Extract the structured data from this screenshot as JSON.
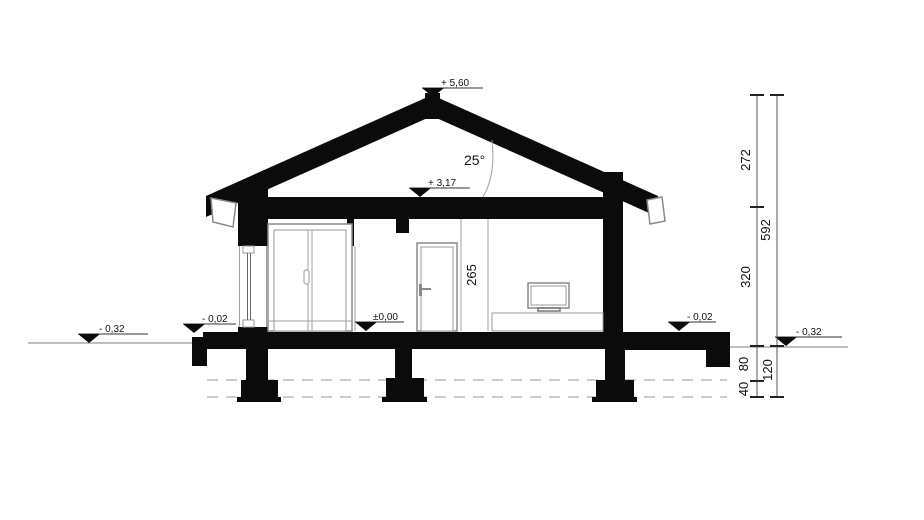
{
  "markers": {
    "peak": "+ 5,60",
    "ceiling": "+ 3,17",
    "floor": "±0,00",
    "terrace_left": "- 0,02",
    "terrace_right": "- 0,02",
    "ground_left": "- 0,32",
    "ground_right": "- 0,32"
  },
  "roof": {
    "pitch": "25°"
  },
  "dims": {
    "attic_height": "272",
    "overall_height": "592",
    "storey_height": "320",
    "room_height": "265",
    "plinth": "80",
    "footing": "40",
    "below_ground": "120"
  }
}
